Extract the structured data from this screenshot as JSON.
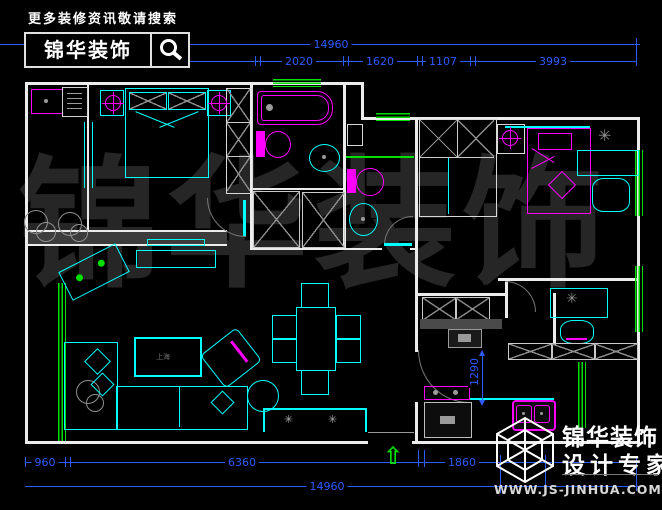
{
  "header": {
    "search_hint": "更多装修资讯敬请搜索",
    "brand": "锦华装饰"
  },
  "watermark": "锦华装饰",
  "dims": {
    "top_total": "14960",
    "top_segments": [
      "1560",
      "3820",
      "2020",
      "1620",
      "1107",
      "3993"
    ],
    "bottom_segments": [
      "960",
      "6360",
      "1860"
    ],
    "bottom_total": "14960",
    "kitchen_opening": "1290"
  },
  "labels": {
    "coffee_table": "上海",
    "sideboard_decor": "✳",
    "desk_plant": "✳",
    "entrance_arrow": "⇧"
  },
  "logo": {
    "brand": "锦华装饰",
    "tagline": "设计专家",
    "url": "WWW.JS-JINHUA.COM"
  },
  "colors": {
    "background": "#000000",
    "dimension_blue": "#2e5bff",
    "furniture_cyan": "#00ffff",
    "fixture_magenta": "#ff00ff",
    "window_green": "#00e000",
    "wall_white": "#ececec",
    "watermark_gray": "#262626"
  }
}
